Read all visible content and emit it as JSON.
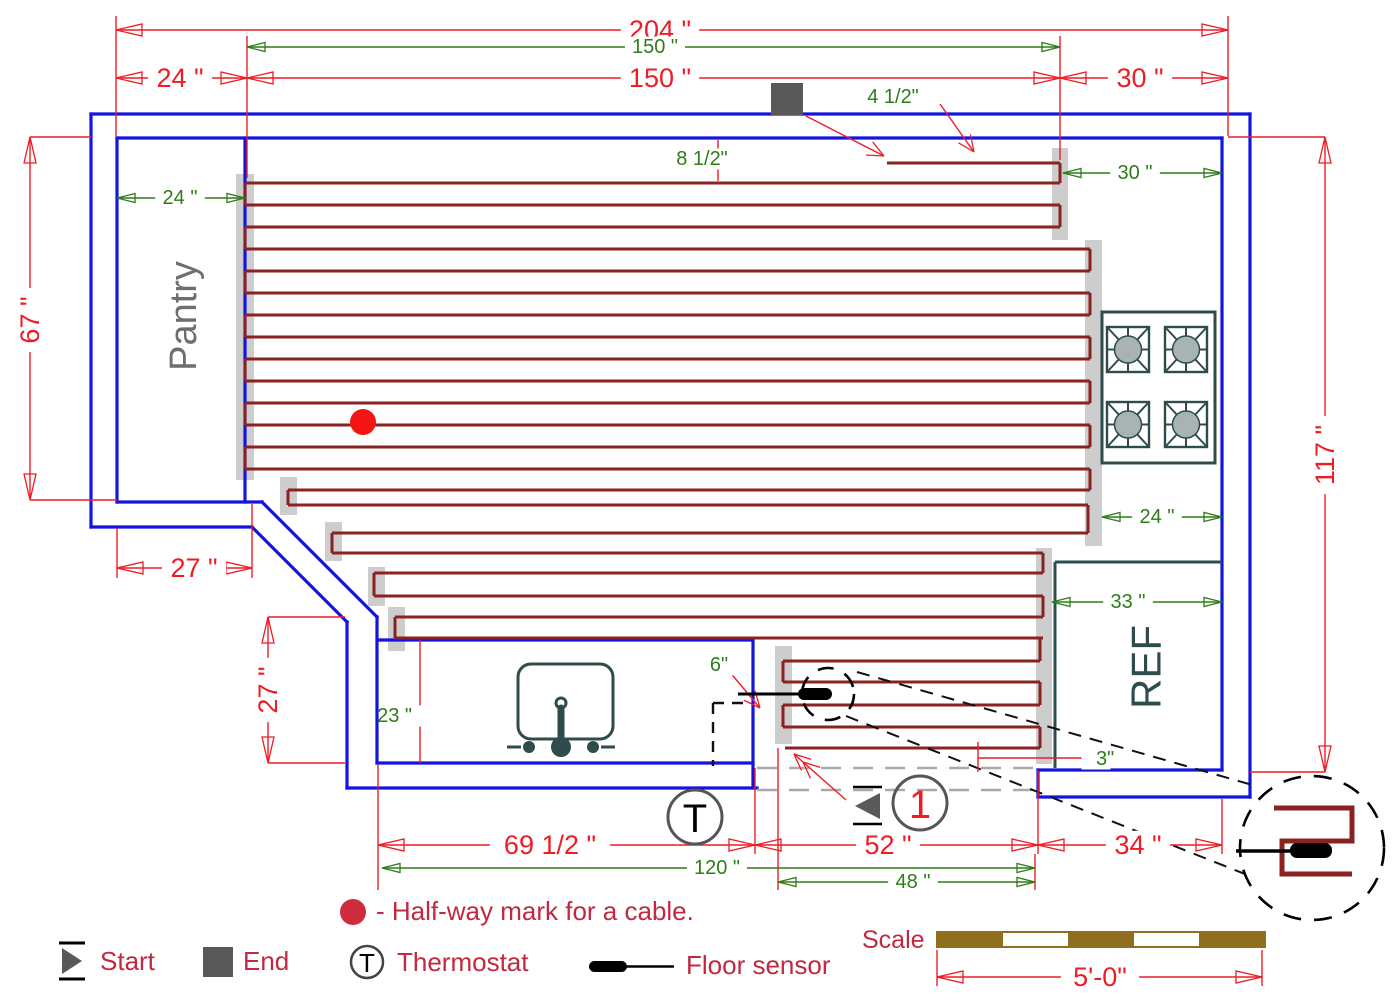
{
  "texts": {
    "pantry": "Pantry",
    "ref": "REF",
    "halfway_note": "- Half-way mark for a cable.",
    "scale_label": "Scale",
    "thermostat_symbol": "T",
    "cable_number": "1",
    "legend": {
      "start": "Start",
      "end": "End",
      "thermostat": "Thermostat",
      "floor_sensor": "Floor sensor"
    }
  },
  "colors": {
    "wall": "#1414dd",
    "cable": "#8b2121",
    "dim_red": "#ee1c25",
    "dim_green": "#2e7d1a",
    "legend_text": "#c22840",
    "gray_bar": "#cdcdcd",
    "fixture": "#2f4c4c",
    "marker_gray": "#595959",
    "burner": "#a8b4b4",
    "pantry_text": "#6e6e6e",
    "halfway_dot_plan": "#f51414",
    "open_dash": "#a9a9a9",
    "scale_brown": "#8f6e1e"
  },
  "plan": {
    "walls": [
      [
        91,
        527,
        91,
        114
      ],
      [
        91,
        114,
        1250,
        114
      ],
      [
        1250,
        114,
        1250,
        797
      ],
      [
        1250,
        797,
        1038,
        797
      ],
      [
        1038,
        797,
        1038,
        770
      ],
      [
        117,
        502,
        117,
        138
      ],
      [
        117,
        138,
        1222,
        138
      ],
      [
        1222,
        138,
        1222,
        770
      ],
      [
        1222,
        770,
        1038,
        770
      ],
      [
        117,
        502,
        262,
        502
      ],
      [
        91,
        527,
        252,
        527
      ],
      [
        262,
        502,
        377,
        617
      ],
      [
        252,
        527,
        347,
        622
      ],
      [
        377,
        617,
        377,
        763
      ],
      [
        347,
        622,
        347,
        788
      ],
      [
        377,
        763,
        753,
        763
      ],
      [
        347,
        788,
        757,
        788
      ],
      [
        245,
        138,
        245,
        502
      ],
      [
        377,
        640,
        753,
        640
      ],
      [
        753,
        640,
        753,
        788
      ]
    ],
    "gray_bars": [
      [
        236,
        174,
        18,
        306
      ],
      [
        1052,
        148,
        16,
        92
      ],
      [
        1085,
        240,
        17,
        306
      ],
      [
        1036,
        548,
        16,
        216
      ],
      [
        775,
        646,
        17,
        98
      ],
      [
        280,
        477,
        17,
        38
      ],
      [
        325,
        522,
        17,
        39
      ],
      [
        368,
        567,
        17,
        39
      ],
      [
        388,
        607,
        17,
        44
      ]
    ],
    "cable_rows": [
      [
        887,
        1060,
        163
      ],
      [
        245,
        1060,
        183
      ],
      [
        245,
        1060,
        205
      ],
      [
        245,
        1060,
        227
      ],
      [
        245,
        1090,
        249
      ],
      [
        245,
        1090,
        271
      ],
      [
        245,
        1090,
        293
      ],
      [
        245,
        1090,
        315
      ],
      [
        245,
        1090,
        337
      ],
      [
        245,
        1090,
        359
      ],
      [
        245,
        1090,
        381
      ],
      [
        245,
        1090,
        403
      ],
      [
        245,
        1090,
        425
      ],
      [
        245,
        1090,
        447
      ],
      [
        245,
        1090,
        469
      ],
      [
        288,
        1090,
        490
      ],
      [
        288,
        1088,
        505
      ],
      [
        332,
        1088,
        533
      ],
      [
        332,
        1043,
        553
      ],
      [
        374,
        1043,
        573
      ],
      [
        374,
        1043,
        596
      ],
      [
        395,
        1043,
        617
      ],
      [
        395,
        1043,
        638
      ],
      [
        783,
        1040,
        661
      ],
      [
        783,
        1040,
        682
      ],
      [
        783,
        1040,
        705
      ],
      [
        783,
        1040,
        727
      ],
      [
        785,
        1040,
        748
      ]
    ],
    "cable_links": [
      [
        1060,
        163,
        183
      ],
      [
        1060,
        205,
        227
      ],
      [
        245,
        183,
        205
      ],
      [
        245,
        227,
        249
      ],
      [
        245,
        271,
        293
      ],
      [
        245,
        315,
        337
      ],
      [
        245,
        359,
        381
      ],
      [
        245,
        403,
        425
      ],
      [
        245,
        447,
        469
      ],
      [
        1090,
        249,
        271
      ],
      [
        1090,
        293,
        315
      ],
      [
        1090,
        337,
        359
      ],
      [
        1090,
        381,
        403
      ],
      [
        1090,
        425,
        447
      ],
      [
        1090,
        469,
        490
      ],
      [
        288,
        490,
        505
      ],
      [
        1088,
        505,
        533
      ],
      [
        332,
        533,
        553
      ],
      [
        1043,
        553,
        573
      ],
      [
        374,
        573,
        596
      ],
      [
        1043,
        596,
        617
      ],
      [
        395,
        617,
        638
      ],
      [
        1040,
        638,
        661
      ],
      [
        783,
        661,
        682
      ],
      [
        1040,
        682,
        705
      ],
      [
        783,
        705,
        727
      ],
      [
        1040,
        727,
        748
      ]
    ],
    "ext_lines": [
      [
        116,
        16,
        116,
        136
      ],
      [
        1228,
        16,
        1228,
        136
      ],
      [
        247,
        36,
        247,
        178
      ],
      [
        1060,
        36,
        1060,
        160
      ],
      [
        30,
        137,
        91,
        137
      ],
      [
        30,
        500,
        117,
        500
      ],
      [
        1228,
        137,
        1325,
        137
      ],
      [
        1250,
        772,
        1325,
        772
      ],
      [
        117,
        528,
        117,
        578
      ],
      [
        252,
        504,
        252,
        578
      ],
      [
        268,
        617,
        345,
        617
      ],
      [
        268,
        763,
        345,
        763
      ],
      [
        718,
        140,
        718,
        181
      ],
      [
        420,
        640,
        420,
        763
      ],
      [
        978,
        742,
        978,
        772
      ],
      [
        978,
        758,
        1092,
        758
      ],
      [
        378,
        765,
        378,
        890
      ],
      [
        755,
        768,
        755,
        854
      ],
      [
        778,
        748,
        778,
        890
      ],
      [
        1035,
        854,
        1035,
        890
      ],
      [
        1038,
        770,
        1038,
        854
      ],
      [
        1222,
        799,
        1222,
        854
      ],
      [
        937,
        950,
        937,
        986
      ],
      [
        1262,
        950,
        1262,
        986
      ]
    ],
    "leaders": [
      {
        "p": [
          806,
          116,
          884,
          156
        ],
        "double": false
      },
      {
        "p": [
          940,
          104,
          974,
          152
        ],
        "double": false
      },
      {
        "p": [
          728,
          670,
          760,
          708
        ],
        "double": false
      },
      {
        "p": [
          846,
          800,
          794,
          754
        ],
        "double": true
      }
    ],
    "open_dashes": [
      [
        757,
        768,
        1036,
        768
      ],
      [
        757,
        790,
        1036,
        790
      ]
    ],
    "callout_dashes": [
      [
        857,
        672,
        1256,
        786
      ],
      [
        846,
        716,
        1250,
        876
      ]
    ],
    "thermo_dashes": [
      [
        713,
        703,
        746,
        703
      ],
      [
        713,
        703,
        713,
        766
      ]
    ],
    "dims_red": [
      {
        "t": "204 \"",
        "o": "h",
        "x1": 116,
        "x2": 1228,
        "y": 30,
        "tx": 660
      },
      {
        "t": "24 \"",
        "o": "h",
        "x1": 116,
        "x2": 247,
        "y": 78,
        "tx": 180
      },
      {
        "t": "150 \"",
        "o": "h",
        "x1": 247,
        "x2": 1060,
        "y": 78,
        "tx": 660
      },
      {
        "t": "30 \"",
        "o": "h",
        "x1": 1060,
        "x2": 1228,
        "y": 78,
        "tx": 1140
      },
      {
        "t": "67 \"",
        "o": "v",
        "x": 30,
        "y1": 137,
        "y2": 500,
        "ty": 320
      },
      {
        "t": "117 \"",
        "o": "v",
        "x": 1325,
        "y1": 137,
        "y2": 772,
        "ty": 455
      },
      {
        "t": "27 \"",
        "o": "h",
        "x1": 117,
        "x2": 252,
        "y": 568,
        "tx": 194
      },
      {
        "t": "27 \"",
        "o": "v",
        "x": 268,
        "y1": 617,
        "y2": 763,
        "ty": 690
      },
      {
        "t": "69 1/2 \"",
        "o": "h",
        "x1": 378,
        "x2": 755,
        "y": 845,
        "tx": 550
      },
      {
        "t": "52 \"",
        "o": "h",
        "x1": 755,
        "x2": 1038,
        "y": 845,
        "tx": 888
      },
      {
        "t": "34 \"",
        "o": "h",
        "x1": 1038,
        "x2": 1222,
        "y": 845,
        "tx": 1138
      },
      {
        "t": "5'-0\"",
        "o": "h",
        "x1": 937,
        "x2": 1262,
        "y": 977,
        "tx": 1100
      }
    ],
    "dims_green": [
      {
        "t": "150 \"",
        "o": "h",
        "x1": 247,
        "x2": 1060,
        "y": 47,
        "tx": 655
      },
      {
        "t": "24 \"",
        "o": "h",
        "x1": 117,
        "x2": 245,
        "y": 198,
        "tx": 180
      },
      {
        "t": "30 \"",
        "o": "h",
        "x1": 1063,
        "x2": 1222,
        "y": 173,
        "tx": 1135
      },
      {
        "t": "24 \"",
        "o": "h",
        "x1": 1102,
        "x2": 1222,
        "y": 517,
        "tx": 1157
      },
      {
        "t": "33 \"",
        "o": "h",
        "x1": 1052,
        "x2": 1222,
        "y": 602,
        "tx": 1128
      },
      {
        "t": "120 \"",
        "o": "h",
        "x1": 382,
        "x2": 1035,
        "y": 868,
        "tx": 717
      },
      {
        "t": "48 \"",
        "o": "h",
        "x1": 778,
        "x2": 1035,
        "y": 882,
        "tx": 913
      }
    ],
    "free_labels": [
      {
        "t": "4 1/2\"",
        "x": 893,
        "y": 97,
        "a": "middle"
      },
      {
        "t": "8 1/2\"",
        "x": 702,
        "y": 159,
        "a": "middle"
      },
      {
        "t": "6\"",
        "x": 719,
        "y": 665,
        "a": "middle"
      },
      {
        "t": "3\"",
        "x": 1096,
        "y": 759,
        "a": "start"
      },
      {
        "t": "23 \"",
        "x": 412,
        "y": 716,
        "a": "end"
      }
    ],
    "stove": {
      "x": 1102,
      "y": 312,
      "w": 113,
      "h": 151,
      "bw": 42,
      "bh": 45,
      "burners": [
        [
          1107,
          327
        ],
        [
          1165,
          327
        ],
        [
          1107,
          402
        ],
        [
          1165,
          402
        ]
      ]
    },
    "sink": {
      "box": [
        518,
        664,
        95,
        75
      ],
      "knob": [
        561,
        703,
        5
      ],
      "bar": [
        561,
        708,
        561,
        744
      ],
      "base": [
        561,
        747,
        10
      ],
      "handles": [
        [
          529,
          747
        ],
        [
          593,
          747
        ]
      ],
      "stems": [
        [
          507,
          747,
          521,
          747
        ],
        [
          601,
          747,
          615,
          747
        ]
      ]
    },
    "ref_lines": [
      [
        1055,
        562,
        1222,
        562
      ],
      [
        1055,
        562,
        1055,
        768
      ]
    ],
    "markers": {
      "end_square": [
        771,
        83,
        32,
        32
      ],
      "halfway_dot": [
        363,
        422,
        13
      ],
      "start_tri": {
        "pts": "855,806 880,793 880,819",
        "lines": [
          [
            853,
            787,
            882,
            787
          ],
          [
            853,
            824,
            882,
            824
          ]
        ]
      },
      "thermostat": {
        "c": [
          695,
          817
        ],
        "r": 27
      },
      "circle1": {
        "c": [
          920,
          803
        ],
        "r": 27
      },
      "sensor": {
        "line": [
          738,
          694,
          800,
          694
        ],
        "blob": [
          798,
          688,
          34,
          12
        ],
        "circle": [
          828,
          694,
          26
        ]
      },
      "magnifier": {
        "c": [
          1312,
          848
        ],
        "r": 72,
        "path": "M1274,808 H1352 V841 H1282 V874 H1352",
        "sensor_line": [
          1236,
          851,
          1292,
          851
        ],
        "blob": [
          1290,
          843,
          42,
          15
        ]
      }
    },
    "room_labels": {
      "pantry": {
        "x": 184,
        "y": 316,
        "fs": 38
      },
      "ref": {
        "x": 1146,
        "y": 667,
        "fs": 42
      }
    }
  }
}
